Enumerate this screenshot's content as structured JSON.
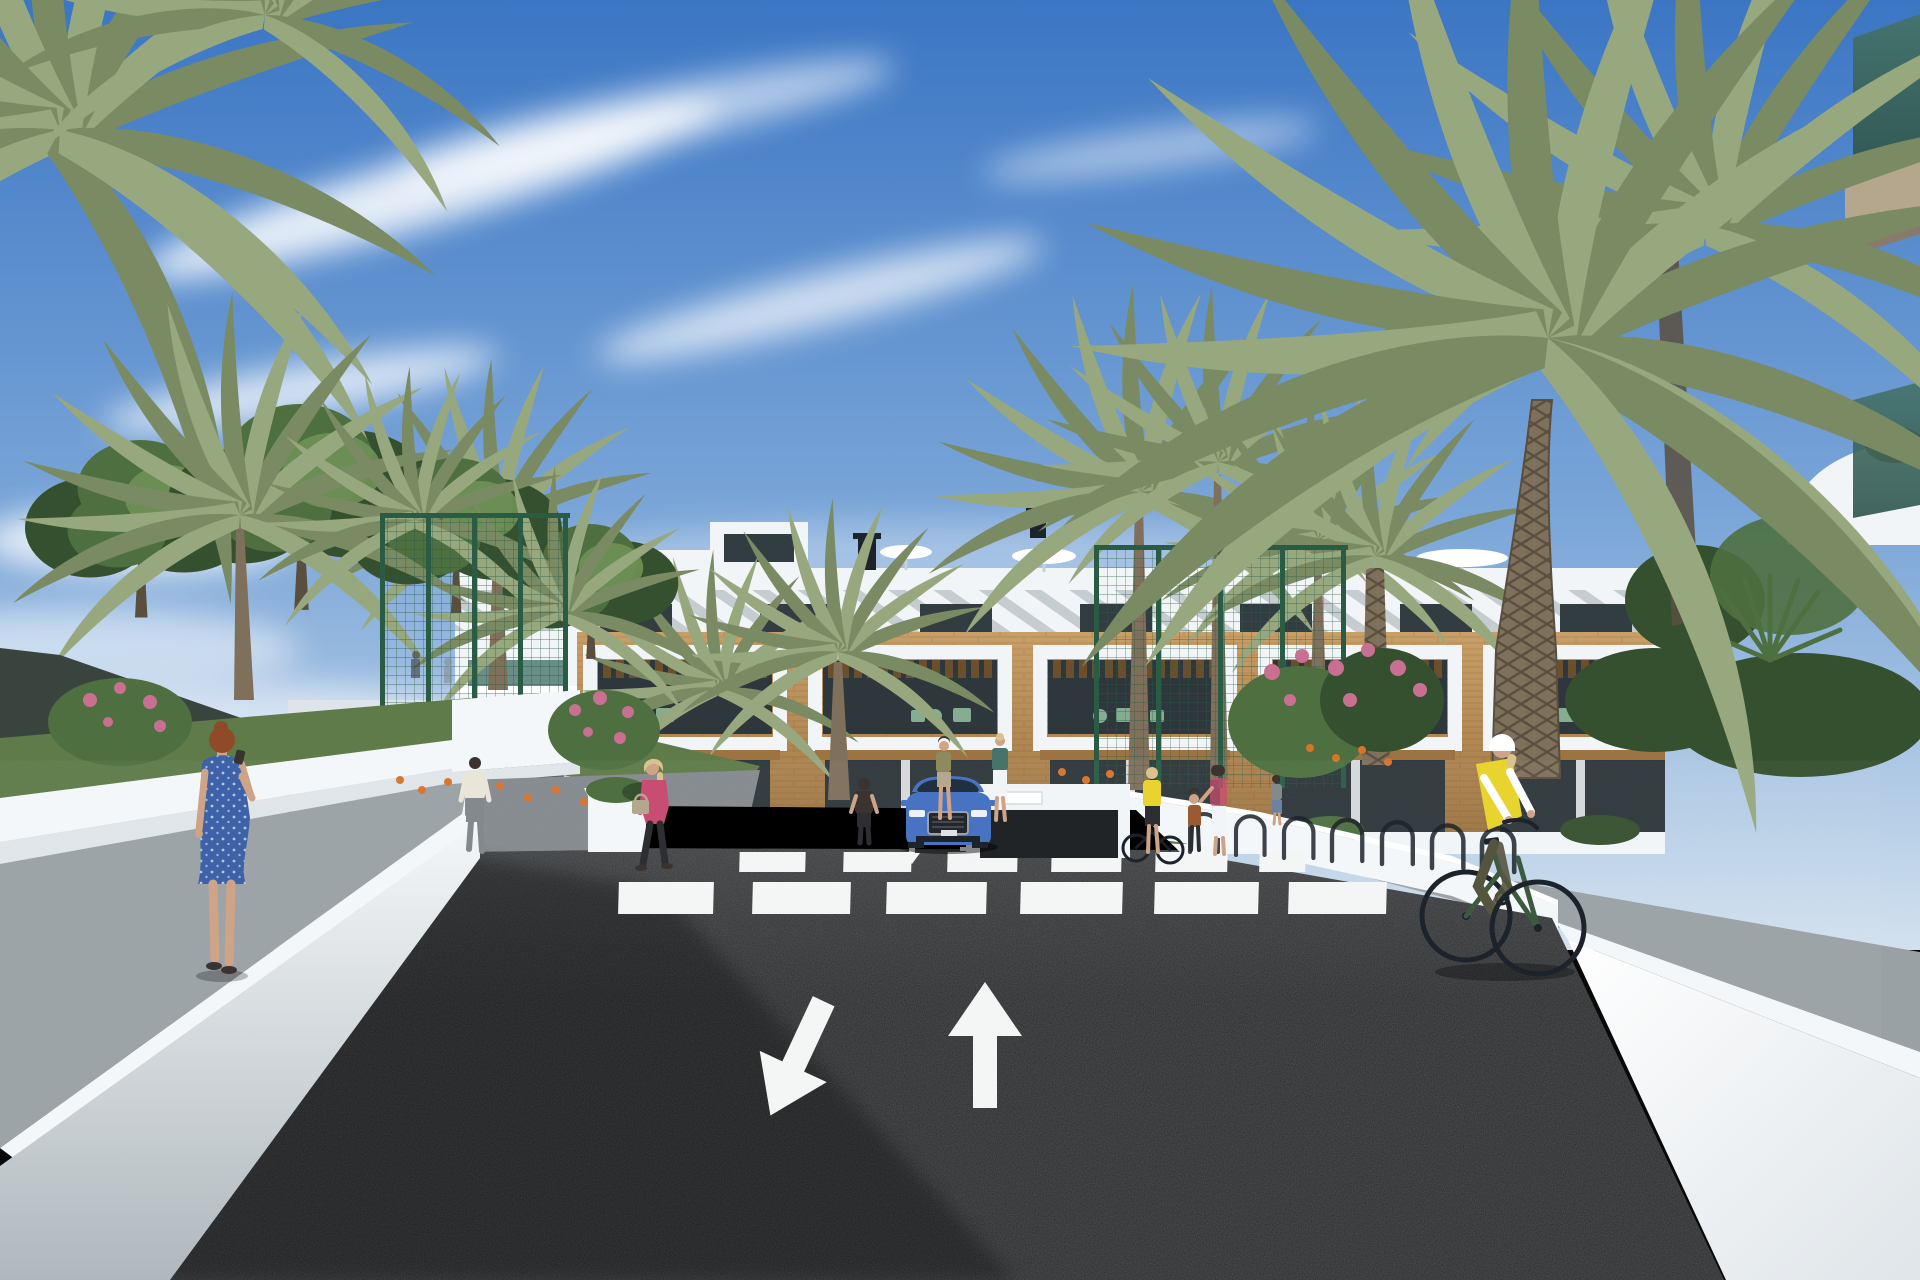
{
  "scene": {
    "type": "architectural-render",
    "setting": "Sunny street view of a new-build white Mediterranean apartment complex with palm trees, pedestrians and a cyclist",
    "time_of_day": "daytime",
    "sky": "blue with wispy clouds"
  },
  "colors": {
    "sky_top": "#3b76c4",
    "sky_mid": "#7ba6d8",
    "sky_horizon": "#d3e1ee",
    "white": "#ffffff",
    "building_white": "#f2f5f7",
    "building_shade": "#d9e0e5",
    "slat_gray": "#9aa5ac",
    "window_dark": "#323d42",
    "glass_teal": "#46736a",
    "teal_dark": "#2e544e",
    "wood_band": "#c99f68",
    "wood_dark": "#9c7442",
    "pergola": "#6b4f2c",
    "tan_pier": "#caa371",
    "interior_dark": "#2e373b",
    "furniture_green": "#84ad92",
    "fence_green": "#2a5c45",
    "foliage_dark": "#35502f",
    "foliage_mid": "#4e7040",
    "foliage_light": "#6f9156",
    "palm_frond": "#7a8a62",
    "palm_light": "#98a87e",
    "trunk": "#7e705b",
    "trunk_dark": "#5a4f3f",
    "grass": "#5e7b49",
    "flower_orange": "#d7732c",
    "flower_pink": "#c96f92",
    "canopy_dark": "#3a443f",
    "road": "#1e2124",
    "road_far": "#3b3e41",
    "ramp_gray": "#44484b",
    "marking_white": "#f4f6f6",
    "sidewalk": "#9aa1a5",
    "sidewalk_dark": "#83898d",
    "wall_white": "#f4f7f9",
    "wall_face": "#dfe5e9",
    "wall_dark": "#b0b8bd",
    "slab_tan": "#b5a78d",
    "car_blue": "#4873c2",
    "car_dark": "#1d232b",
    "car_glass": "#20303e",
    "vest_yellow": "#e9d42f",
    "bike_green": "#3c5a40",
    "dress_blue": "#3e62a8",
    "jacket_pink": "#c94d72",
    "shirt_cream": "#eae5d9",
    "pants_dark": "#2c2e31",
    "pants_olive": "#55543f",
    "olive_top": "#8f8a5c",
    "kid_brown": "#9a5b33",
    "denim": "#6b82a0",
    "skin": "#cfa486",
    "hair_red": "#8f4b28",
    "hair_blonde": "#d9c28c",
    "hair_dark": "#3a3330"
  },
  "inventory": {
    "building": {
      "type": "three-storey apartment block",
      "balcony_modules": 5,
      "rooftop_features": [
        "chimneys",
        "patio umbrellas",
        "pergola shade slats",
        "stair tower"
      ],
      "materials": [
        "white render",
        "timber cladding band",
        "dark glazing",
        "white balcony frames"
      ]
    },
    "road": {
      "surface": "dark asphalt",
      "markings": [
        "large down-left arrow",
        "large up arrow",
        "small ramp arrows",
        "zebra crosswalk"
      ],
      "crosswalk_stripes_far": 6,
      "crosswalk_stripes_near": 6
    },
    "vehicles": [
      {
        "type": "SUV",
        "color": "blue",
        "position": "exiting garage ramp, facing viewer"
      }
    ],
    "people": [
      {
        "id": "woman-blue-dress",
        "desc": "red-haired woman in blue patterned dress on phone, foreground left"
      },
      {
        "id": "woman-pink-jacket",
        "desc": "blonde woman in pink jacket with tan handbag walking left"
      },
      {
        "id": "man-white-shirt",
        "desc": "man in white shirt walking toward court fence"
      },
      {
        "id": "woman-crosswalk",
        "desc": "woman in dark top standing beside crosswalk"
      },
      {
        "id": "women-by-ramp",
        "desc": "two women chatting right of the garage ramp"
      },
      {
        "id": "group-bike-racks",
        "desc": "woman with bicycle, child and two women at the bike racks"
      },
      {
        "id": "cyclist",
        "desc": "cyclist in yellow hi-vis vest and white helmet riding toward viewer"
      },
      {
        "id": "figures-behind-fence",
        "desc": "distant figures inside fenced court"
      }
    ],
    "vegetation": {
      "palm_trees": 14,
      "leafy_trees": 4,
      "flower_colors": [
        "orange",
        "pink"
      ],
      "hedges": true
    },
    "site_features": [
      "green mesh sports-court fence",
      "dark shade sail",
      "white boundary walls",
      "bike racks",
      "zebra crossing",
      "underground garage ramp"
    ]
  }
}
